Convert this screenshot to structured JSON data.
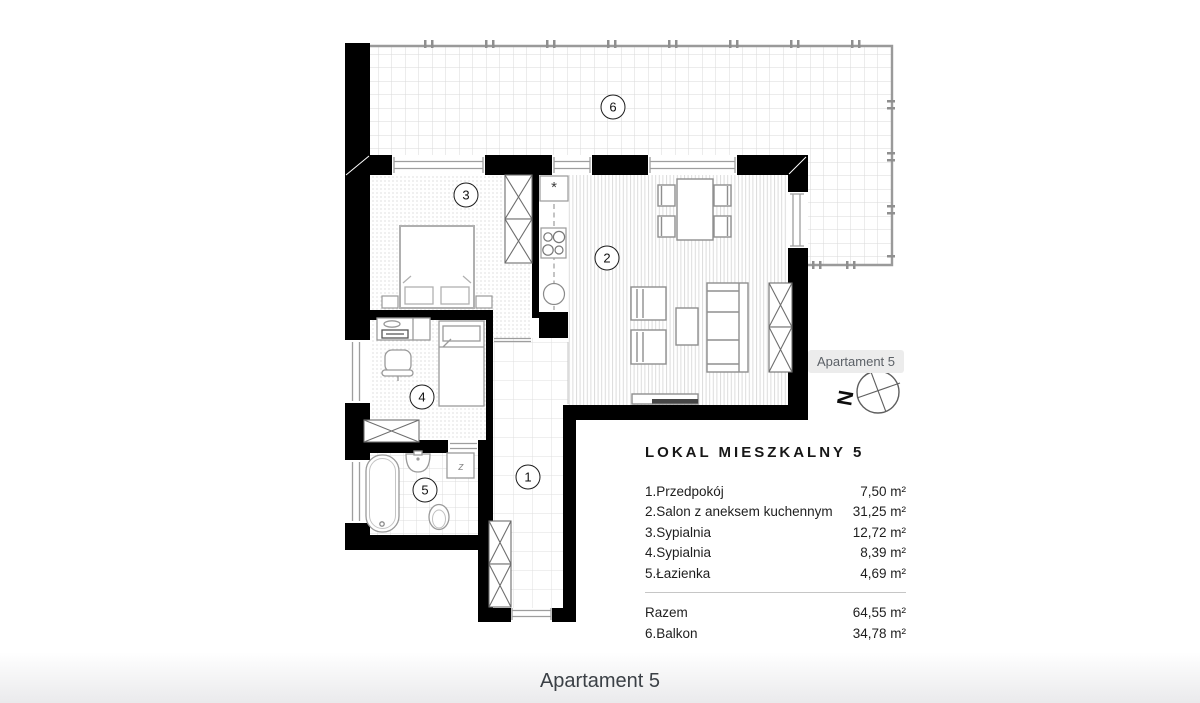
{
  "viewer": {
    "tooltip": "Apartament 5",
    "footer_title": "Apartament 5"
  },
  "legend": {
    "title": "LOKAL MIESZKALNY 5",
    "rows": [
      {
        "label": "1.Przedpokój",
        "value": "7,50 m²"
      },
      {
        "label": "2.Salon z aneksem kuchennym",
        "value": "31,25 m²"
      },
      {
        "label": "3.Sypialnia",
        "value": "12,72 m²"
      },
      {
        "label": "4.Sypialnia",
        "value": "8,39 m²"
      },
      {
        "label": "5.Łazienka",
        "value": "4,69 m²"
      }
    ],
    "total": {
      "label": "Razem",
      "value": "64,55 m²"
    },
    "balcony": {
      "label": "6.Balkon",
      "value": "34,78 m²"
    }
  },
  "badges": {
    "hallway": "1",
    "living_room": "2",
    "bedroom_1": "3",
    "bedroom_2": "4",
    "bathroom": "5",
    "balcony": "6"
  },
  "plan_symbols": {
    "fridge": "*",
    "washer": "z",
    "compass_letter": "N"
  },
  "colors": {
    "wall": "#000000",
    "tooltip_bg": "#ececec",
    "railing": "#9a9a9a"
  }
}
